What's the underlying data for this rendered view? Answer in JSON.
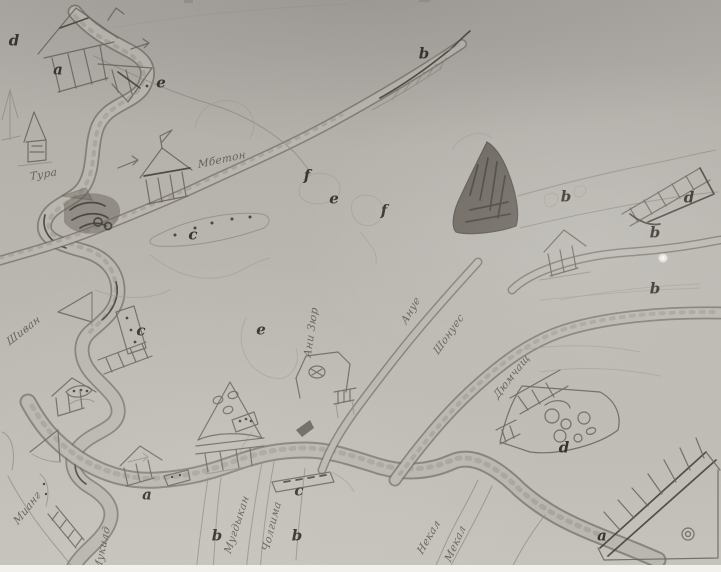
{
  "colors": {
    "paper": "#b8b5ae",
    "pencil": "#5f5a52",
    "pencil_dark": "#45413a",
    "pencil_faint": "#97928a",
    "scan_edge": "#f2f1ee"
  },
  "letters": [
    {
      "char": "d"
    },
    {
      "char": "a"
    },
    {
      "char": "e"
    },
    {
      "char": "b"
    },
    {
      "char": "f"
    },
    {
      "char": "e"
    },
    {
      "char": "f"
    },
    {
      "char": "b"
    },
    {
      "char": "d"
    },
    {
      "char": "b"
    },
    {
      "char": "b"
    },
    {
      "char": "c"
    },
    {
      "char": "c"
    },
    {
      "char": "e"
    },
    {
      "char": "a"
    },
    {
      "char": "c"
    },
    {
      "char": "b"
    },
    {
      "char": "b"
    },
    {
      "char": "d"
    },
    {
      "char": "a"
    }
  ],
  "place_names": [
    {
      "text": "Тура"
    },
    {
      "text": "Мбетон"
    },
    {
      "text": "Шиван"
    },
    {
      "text": "Ани Зюр"
    },
    {
      "text": "Ануе"
    },
    {
      "text": "Шонуес"
    },
    {
      "text": "Дюмчащ"
    },
    {
      "text": "Мианг"
    },
    {
      "text": "Мукилд"
    },
    {
      "text": "Мугдыкан"
    },
    {
      "text": "Чолгима"
    },
    {
      "text": "Некал"
    },
    {
      "text": "Мекал"
    }
  ]
}
